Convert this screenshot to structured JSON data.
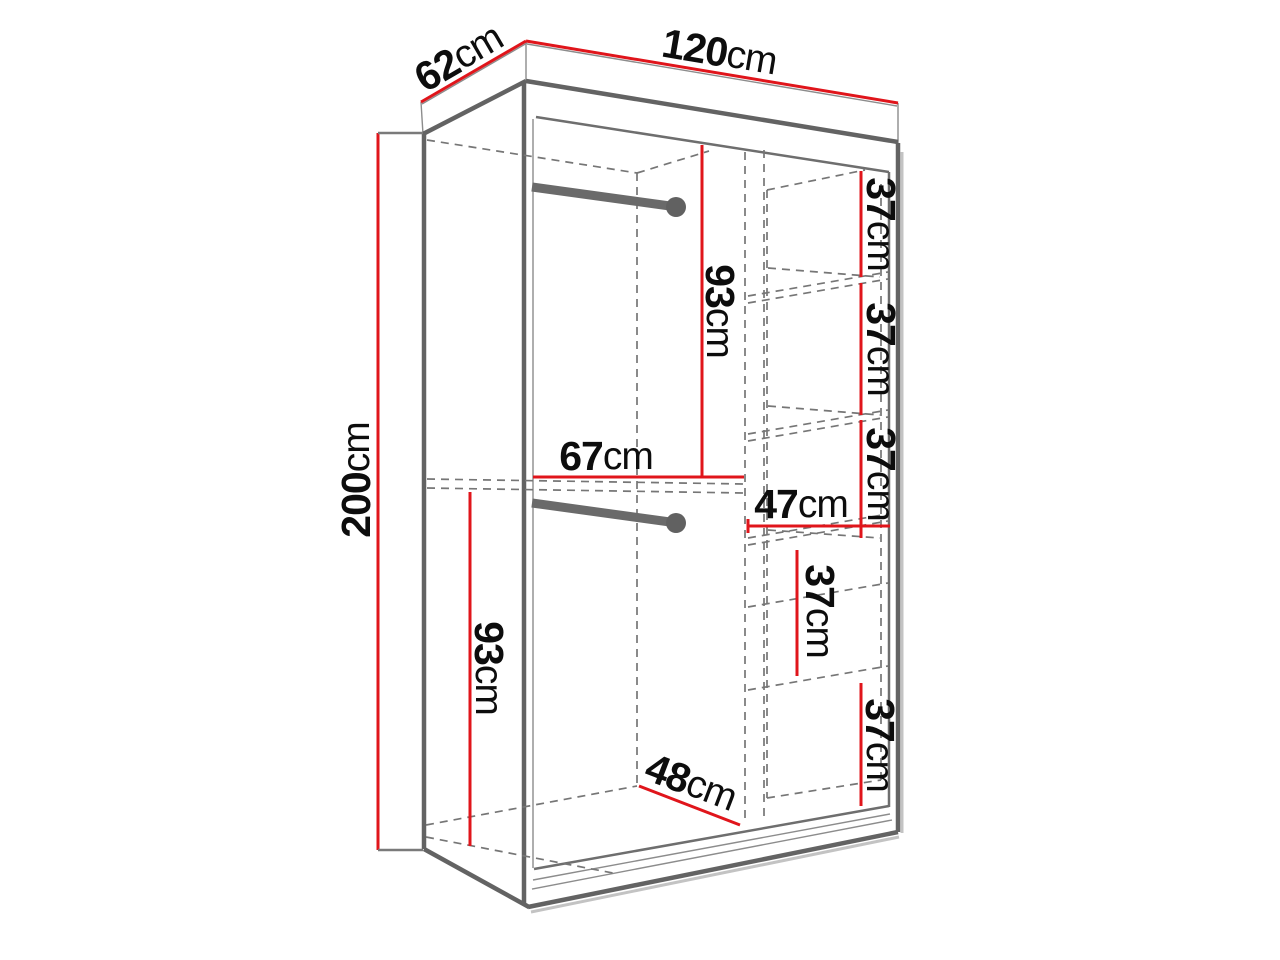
{
  "diagram": {
    "kind": "wardrobe-dimension-drawing",
    "background": "#ffffff",
    "colors": {
      "dimension_line": "#e0151b",
      "structure_line": "#636363",
      "hidden_line": "#767676",
      "label_text": "#0d0d0d"
    },
    "dimensions": {
      "depth_top": {
        "value": "62",
        "unit": "cm"
      },
      "width_top": {
        "value": "120",
        "unit": "cm"
      },
      "height_left": {
        "value": "200",
        "unit": "cm"
      },
      "upper_section_height": {
        "value": "93",
        "unit": "cm"
      },
      "left_section_width": {
        "value": "67",
        "unit": "cm"
      },
      "right_shelf_width": {
        "value": "47",
        "unit": "cm"
      },
      "lower_section_height": {
        "value": "93",
        "unit": "cm"
      },
      "bottom_depth": {
        "value": "48",
        "unit": "cm"
      },
      "shelf_gap_1": {
        "value": "37",
        "unit": "cm"
      },
      "shelf_gap_2": {
        "value": "37",
        "unit": "cm"
      },
      "shelf_gap_3": {
        "value": "37",
        "unit": "cm"
      },
      "drawer_section_height": {
        "value": "37",
        "unit": "cm"
      },
      "bottom_shelf_gap": {
        "value": "37",
        "unit": "cm"
      }
    }
  }
}
